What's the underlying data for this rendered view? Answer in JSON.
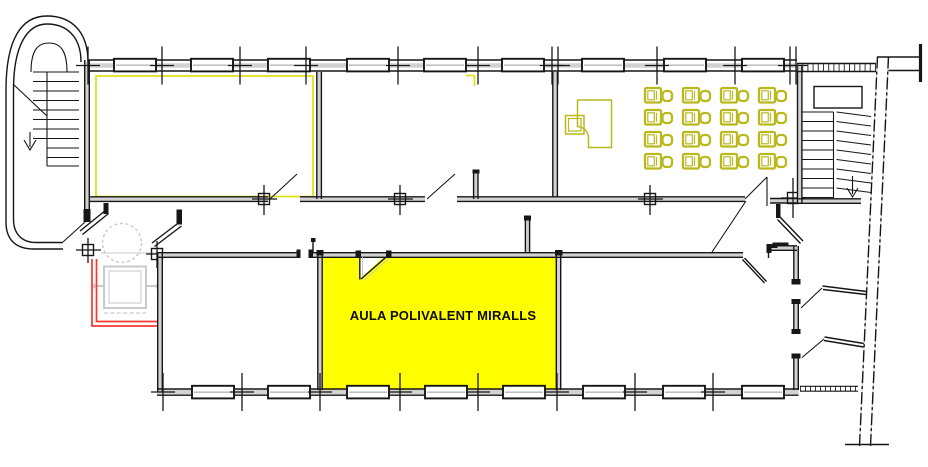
{
  "plan": {
    "highlighted_room": {
      "label": "AULA POLIVALENT MIRALLS",
      "fill": "#ffff00"
    },
    "colors": {
      "background": "#ffffff",
      "wall": "#161616",
      "wall_core": "#d2d2d2",
      "light_gray": "#c9c9c9",
      "highlight_yellow": "#ffff00",
      "highlight_yellow_line": "#dede00",
      "accent_olive": "#b9b91e",
      "alert_red": "#f5392c"
    },
    "classroom": {
      "desk_rows": 4,
      "desk_cols": 4,
      "desk_count": 16,
      "grid": {
        "origin_x": 645,
        "origin_y": 88,
        "dx": 38,
        "dy": 22
      }
    },
    "generated": {
      "windows_top": {
        "y": 58.8,
        "xs": [
          114,
          191,
          268,
          347,
          424,
          502,
          582,
          664,
          742
        ]
      },
      "windows_bottom": {
        "y": 385.8,
        "xs": [
          192,
          268,
          347,
          425,
          503,
          583,
          663,
          742
        ]
      },
      "wall_ticks_top": {
        "y": 65.5,
        "xs": [
          88,
          162,
          240,
          306,
          398,
          478,
          552,
          558,
          657,
          735,
          790,
          796
        ]
      },
      "wall_ticks_bottom": {
        "y": 392,
        "xs": [
          163,
          242,
          320,
          400,
          478,
          557,
          635,
          713
        ]
      }
    },
    "icons": [
      "stairs-icon",
      "elevator-icon",
      "desk-chair-icon",
      "teacher-desk-icon",
      "door-swing-icon",
      "window-icon",
      "direction-arrow-icon"
    ]
  }
}
